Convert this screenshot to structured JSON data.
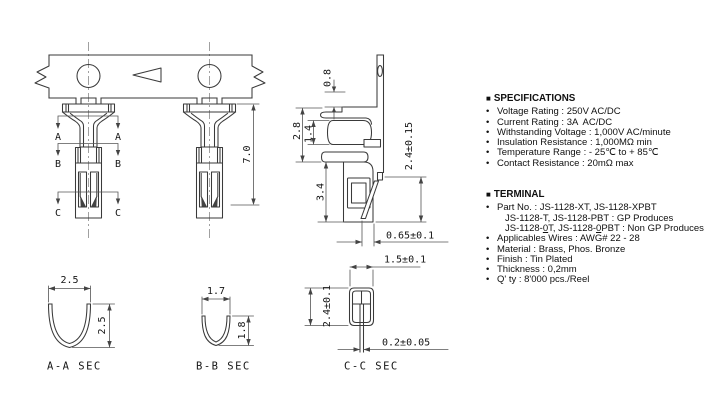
{
  "drawing": {
    "front": {
      "dim_length": "7.0",
      "sec_a": "A",
      "sec_b": "B",
      "sec_c": "C"
    },
    "side": {
      "dim_top": "0.8",
      "dim_28": "2.8",
      "dim_14": "1.4",
      "dim_34": "3.4",
      "dim_24": "2.4±0.15",
      "dim_065": "0.65±0.1"
    },
    "section_cc": {
      "dim_w": "1.5±0.1",
      "dim_h": "2.4±0.1",
      "dim_t": "0.2±0.05",
      "label": "C-C SEC"
    },
    "section_aa": {
      "dim_w": "2.5",
      "dim_h": "2.5",
      "label": "A-A SEC"
    },
    "section_bb": {
      "dim_w": "1.7",
      "dim_h": "1.8",
      "label": "B-B SEC"
    }
  },
  "specs": {
    "marker": "■",
    "bullet": "•",
    "title": "SPECIFICATIONS",
    "items": [
      "Voltage Rating : 250V AC/DC",
      "Current Rating : 3A  AC/DC",
      "Withstanding Voltage : 1,000V AC/minute",
      "Insulation Resistance : 1,000MΩ min",
      "Temperature Range : - 25℃ to + 85℃",
      "Contact Resistance : 20mΩ max"
    ]
  },
  "terminal": {
    "marker": "■",
    "bullet": "•",
    "title": "TERMINAL",
    "part_line1": "Part No. : JS-1128-XT, JS-1128-XPBT",
    "part_line2": "JS-1128-T, JS-1128-PBT : GP Produces",
    "part_line3": {
      "pre": "JS-1128-",
      "u1": "0",
      "mid": "T, JS-1128-",
      "u2": "0",
      "post": "PBT : Non GP Produces"
    },
    "items": [
      "Applicables Wires : AWG# 22 - 28",
      "Material : Brass, Phos. Bronze",
      "Finish : Tin Plated",
      "Thickness : 0,2mm",
      "Q' ty : 8'000 pcs./Reel"
    ]
  },
  "colors": {
    "line": "#3a3a3a",
    "dim": "#555555",
    "text": "#111111",
    "background": "#ffffff"
  }
}
